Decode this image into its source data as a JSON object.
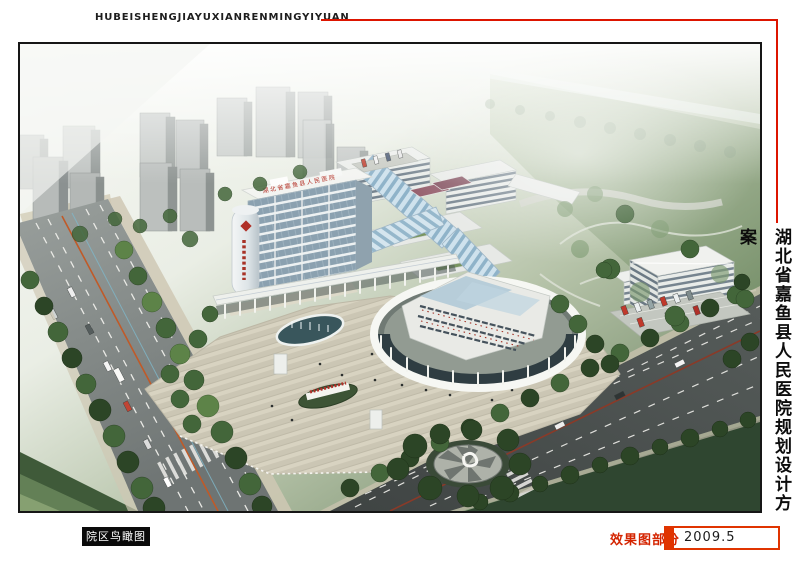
{
  "window": {
    "width": 800,
    "height": 565,
    "background": "#ffffff"
  },
  "header": {
    "pinyin_title": "HUBEISHENGJIAYUXIANRENMINGYIYUAN",
    "rule_color": "#dd1500"
  },
  "side_title": {
    "text": "湖北省嘉鱼县人民医院规划设计方案"
  },
  "figure": {
    "caption_label": "院区鸟瞰图",
    "rooftop_sign": "湖北省嘉鱼县人民医院",
    "subject": "Aerial bird's-eye rendering of hospital campus"
  },
  "footer": {
    "section_label": "效果图部分",
    "date": "2009.5"
  },
  "palette": {
    "accent_red": "#dd1500",
    "caption_bg": "#0a0a0a",
    "caption_fg": "#ffffff",
    "haze_green": "#8fa487",
    "lawn_dark": "#42593b",
    "road_gray": "#7e8381",
    "building_white": "#eef0ed",
    "glass_blue": "#9fbdd2",
    "pavement": "#d6d1bf"
  }
}
